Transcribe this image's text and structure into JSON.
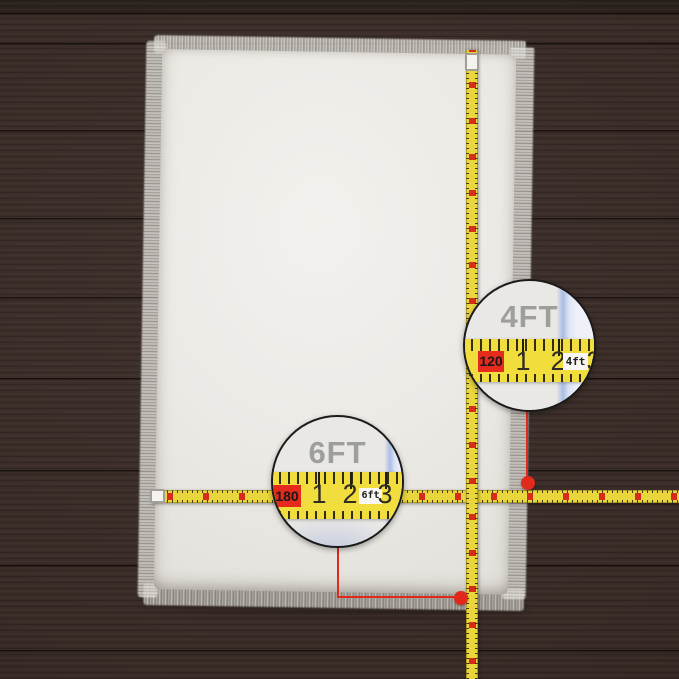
{
  "scene": {
    "description": "White faux fur area rug on dark brown wood planks, measured by yellow tape measures with two magnifier callouts"
  },
  "colors": {
    "wood": "#392b26",
    "wood_seam": "#201813",
    "rug": "#edece7",
    "tape_yellow": "#e9d63b",
    "marker_red": "#e0281a",
    "magnifier_label_gray": "#9c9c99",
    "magnified_edge_blue": "#a9bce6"
  },
  "magnifier_4ft": {
    "label": "4FT",
    "zero_value": "120",
    "marks": [
      "1",
      "2",
      "3"
    ],
    "unit_badge": "4ft"
  },
  "magnifier_6ft": {
    "label": "6FT",
    "zero_value": "180",
    "marks": [
      "1",
      "2",
      "3"
    ],
    "unit_badge": "6ft"
  }
}
